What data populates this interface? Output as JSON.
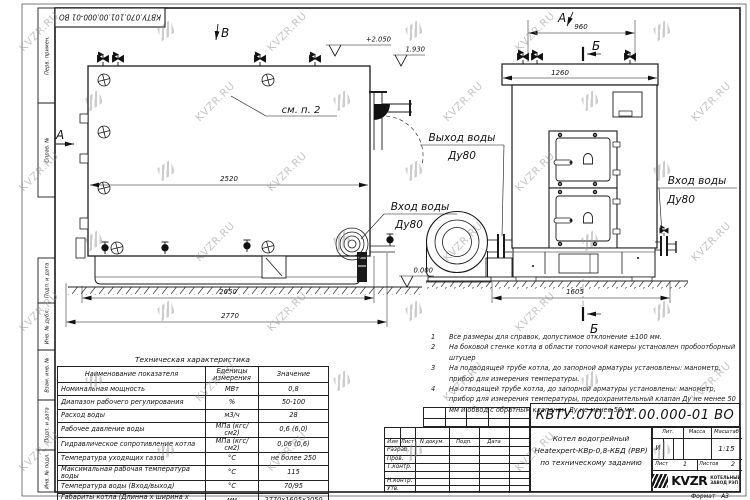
{
  "watermark": {
    "text": "KVZR.RU"
  },
  "frame": {
    "doc_number_top": "КВТУ.070.101.00.000-01 ВО"
  },
  "margin_stamps": [
    "Перв. примен.",
    "Справ. №",
    "Подп. и дата",
    "Инв. № дубл.",
    "Взам. инв. №",
    "Подп. и дата",
    "Инв. № подл."
  ],
  "drawing": {
    "view_label_a_side": "А",
    "view_label_b_top": "В",
    "view_label_a_front": "А",
    "section_label_top": "Б",
    "section_label_bottom": "Б",
    "callout_see_item": "см. п. 2",
    "outlet_label": "Выход воды",
    "outlet_dn": "Ду80",
    "inlet_label_side": "Вход воды",
    "inlet_dn_side": "Ду80",
    "inlet_label_front": "Вход воды",
    "inlet_dn_front": "Ду80",
    "dims": {
      "drum_length": "2520",
      "base_length": "2650",
      "total_length": "2770",
      "valve_span": "960",
      "top_width": "1260",
      "base_width": "1605"
    },
    "elevations": {
      "top": "+2.050",
      "pipe": "1.930",
      "ground": "0.000"
    }
  },
  "notes": {
    "items": [
      {
        "num": "1",
        "text": "Все размеры для справок, допустимое отклонение ±100 мм."
      },
      {
        "num": "2",
        "text": "На боковой стенке котла в области топочной камеры установлен пробоотборный штуцер"
      },
      {
        "num": "3",
        "text": "На подводящей трубе котла, до запорной арматуры установлены: манометр, прибор для измерения температуры."
      },
      {
        "num": "4",
        "text": "На отводящей трубе котла, до запорной арматуры установлены: манометр, прибор для измерения температуры, предохранительный клапан Ду не менее 50 мм и обвод с обратным клапаном Ду не менее 50 мм."
      }
    ]
  },
  "tech_table": {
    "title": "Техническая характеристика",
    "headers": [
      "Наименование показателя",
      "Еденицы измерения",
      "Значение"
    ],
    "rows": [
      [
        "Номинальная мощность",
        "МВт",
        "0,8"
      ],
      [
        "Диапазон рабочего регулирования",
        "%",
        "50-100"
      ],
      [
        "Расход воды",
        "м3/ч",
        "28"
      ],
      [
        "Рабочее давление воды",
        "МПа (кгс/см2)",
        "0,6 (6,0)"
      ],
      [
        "Гидравлическое сопротивление котла",
        "МПа (кгс/см2)",
        "0,06 (0,6)"
      ],
      [
        "Температура уходящих газов",
        "°С",
        "не более 250"
      ],
      [
        "Максимальная рабочая температура воды",
        "°С",
        "115"
      ],
      [
        "Температура воды (Вход/выход)",
        "°С",
        "70/95"
      ],
      [
        "Габариты котла (Длинна х ширина х высота)",
        "мм",
        "2770х1605х2050"
      ]
    ]
  },
  "title_block": {
    "doc_number": "КВТУ.070.101.00.000-01 ВО",
    "columns": {
      "izm": "Изм",
      "list": "Лист",
      "doc": "N докум.",
      "sign": "Подп.",
      "date": "Дата"
    },
    "rows": {
      "developed": "Разраб.",
      "checked": "Пров.",
      "tcontrol": "Т.контр.",
      "ncontrol": "Н.контр.",
      "approved": "Утв."
    },
    "title_line1": "Котел водогрейный",
    "title_line2": "Heatexpert-КВр-0,8-КБД (РВР)",
    "title_line3": "по техническому заданию",
    "lit": {
      "header": "Лит.",
      "value": "И"
    },
    "mass": {
      "header": "Масса"
    },
    "scale": {
      "header": "Масштаб",
      "value": "1:15"
    },
    "sheet": {
      "label": "Лист",
      "value": "1"
    },
    "sheets": {
      "label": "Листов",
      "value": "2"
    },
    "company": {
      "logo_text": "KVZR",
      "line1": "КОТЕЛЬНЫЙ",
      "line2": "ЗАВОД РЭП"
    },
    "format": {
      "label": "Формат",
      "value": "А3"
    }
  }
}
